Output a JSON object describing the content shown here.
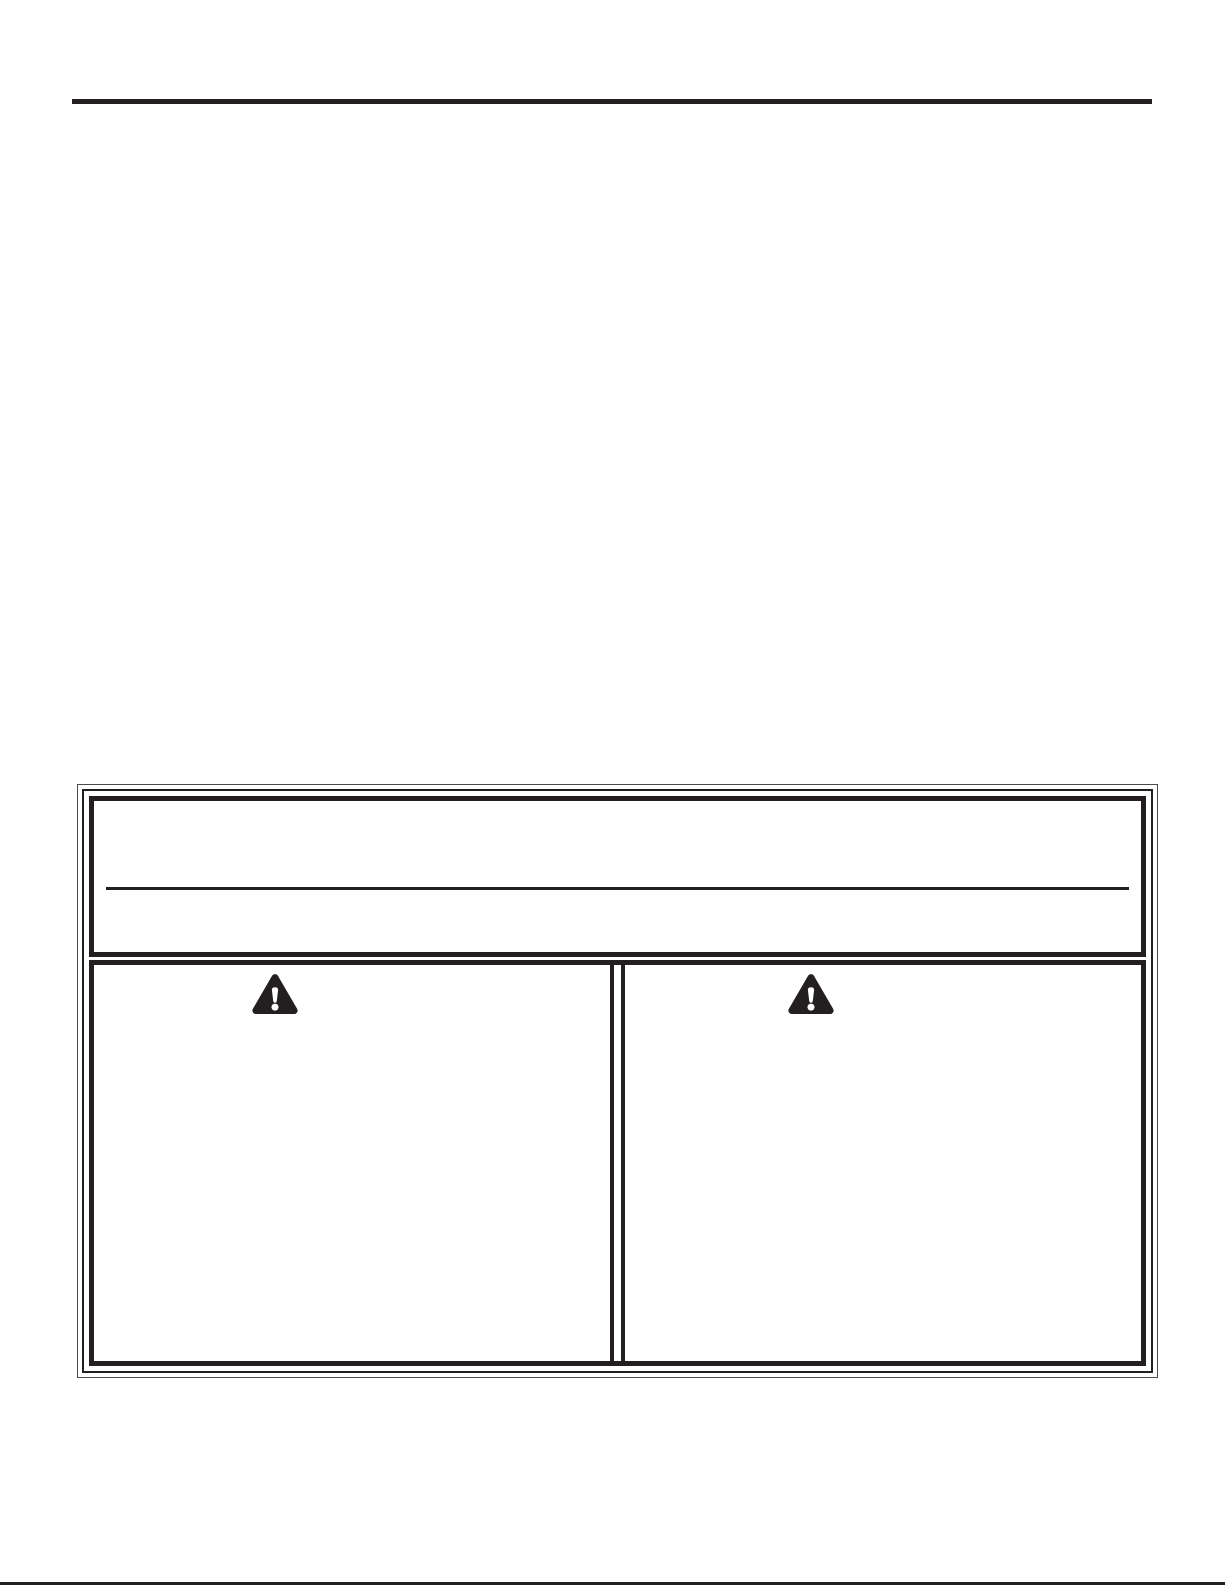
{
  "colors": {
    "ink": "#231f20",
    "background": "#ffffff"
  },
  "icons": {
    "warning_triangle": {
      "name": "warning-triangle-icon",
      "glyph": "⚠",
      "fill": "#231f20",
      "mark_color": "#ffffff"
    }
  },
  "safety_panel": {
    "header_box": {
      "has_divider": true,
      "text": ""
    },
    "warning_columns": [
      {
        "icon": "warning-triangle-icon",
        "text": ""
      },
      {
        "icon": "warning-triangle-icon",
        "text": ""
      }
    ]
  }
}
